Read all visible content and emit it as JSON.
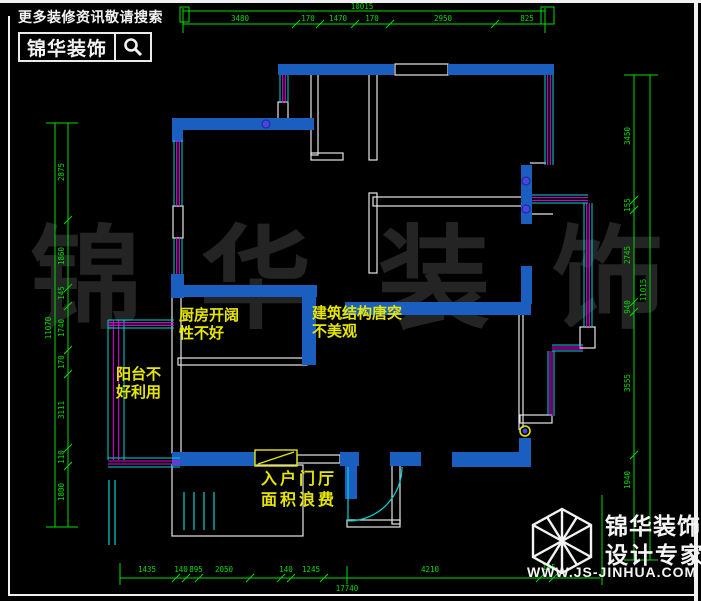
{
  "header": {
    "tagline": "更多装修资讯敬请搜索",
    "brand": "锦华装饰",
    "search_icon": "magnifier-icon"
  },
  "footer": {
    "brand_line1": "锦华装饰",
    "brand_line2": "设计专家",
    "website": "WWW.JS-JINHUA.COM",
    "logo_icon": "wireframe-cube-logo"
  },
  "watermark": {
    "chars": [
      "锦",
      "华",
      "装",
      "饰"
    ]
  },
  "annotations": [
    {
      "lines": [
        "厨房开阔",
        "性不好"
      ]
    },
    {
      "lines": [
        "建筑结构唐突",
        "不美观"
      ]
    },
    {
      "lines": [
        "阳台不",
        "好利用"
      ]
    },
    {
      "lines": [
        "入户门厅",
        "面积浪费"
      ]
    }
  ],
  "colors": {
    "wall": "#1a5fc0",
    "line": "#e6e6e6",
    "green": "#00dc00",
    "magenta": "#e800e8",
    "cyan": "#00d2d2",
    "yellow": "#e6e600",
    "hinge": "#4747e0",
    "bg": "#000000",
    "frame": "#f0f0f0"
  },
  "plan": {
    "walls": [
      [
        278,
        64,
        116,
        11
      ],
      [
        448,
        64,
        106,
        11
      ],
      [
        172,
        118,
        142,
        12
      ],
      [
        172,
        118,
        11,
        24
      ],
      [
        171,
        274,
        13,
        24
      ],
      [
        171,
        285,
        146,
        12
      ],
      [
        302,
        297,
        14,
        68
      ],
      [
        345,
        302,
        186,
        13
      ],
      [
        521,
        266,
        11,
        38
      ],
      [
        521,
        165,
        11,
        59
      ],
      [
        172,
        452,
        83,
        14
      ],
      [
        340,
        452,
        19,
        14
      ],
      [
        390,
        452,
        31,
        14
      ],
      [
        452,
        452,
        79,
        15
      ],
      [
        345,
        465,
        12,
        34
      ],
      [
        519,
        438,
        12,
        16
      ]
    ],
    "white_rects": [
      [
        395,
        64,
        53,
        11
      ],
      [
        311,
        74,
        7,
        81
      ],
      [
        311,
        153,
        32,
        7
      ],
      [
        369,
        74,
        8,
        86
      ],
      [
        369,
        193,
        8,
        80
      ],
      [
        373,
        197,
        154,
        9
      ],
      [
        178,
        358,
        129,
        7
      ],
      [
        172,
        297,
        9,
        156
      ],
      [
        278,
        102,
        10,
        17
      ],
      [
        173,
        206,
        10,
        32
      ],
      [
        172,
        465,
        131,
        71
      ],
      [
        392,
        465,
        8,
        59
      ],
      [
        347,
        520,
        53,
        7
      ],
      [
        297,
        455,
        43,
        8
      ],
      [
        580,
        327,
        15,
        21
      ],
      [
        520,
        415,
        32,
        8
      ]
    ],
    "white_lines": [
      [
        530,
        163,
        546,
        163
      ],
      [
        530,
        214,
        553,
        214
      ],
      [
        519,
        315,
        519,
        430
      ],
      [
        523,
        315,
        523,
        428
      ]
    ],
    "windows": [
      [
        "v",
        280,
        75,
        8,
        28
      ],
      [
        "v",
        174,
        140,
        8,
        66
      ],
      [
        "v",
        174,
        238,
        8,
        36
      ],
      [
        "v",
        545,
        75,
        8,
        90
      ],
      [
        "v",
        584,
        203,
        8,
        124
      ],
      [
        "v",
        548,
        351,
        6,
        65
      ],
      [
        "v",
        108,
        320,
        16,
        140
      ],
      [
        "h",
        532,
        195,
        8,
        56
      ],
      [
        "h",
        552,
        345,
        6,
        31
      ],
      [
        "h",
        108,
        458,
        9,
        72
      ],
      [
        "h",
        108,
        320,
        8,
        66
      ]
    ],
    "cyan_lines": [
      [
        184,
        492,
        184,
        530
      ],
      [
        194,
        492,
        194,
        530
      ],
      [
        204,
        492,
        204,
        530
      ],
      [
        214,
        492,
        214,
        530
      ],
      [
        348,
        467,
        348,
        521
      ],
      [
        109,
        480,
        109,
        545
      ],
      [
        115,
        480,
        115,
        545
      ]
    ],
    "arcs": [
      {
        "d": "M 348 521 A 54 54 0 0 0 402 467"
      }
    ],
    "yellow_rects": [
      [
        255,
        450,
        42,
        16
      ]
    ],
    "yellow_lines": [
      [
        258,
        464,
        294,
        452
      ]
    ],
    "ring_dots": [
      {
        "x": 525,
        "y": 431,
        "r": 5
      }
    ],
    "hinge_dots": [
      {
        "x": 266,
        "y": 124,
        "r": 4
      },
      {
        "x": 526,
        "y": 181,
        "r": 4
      },
      {
        "x": 526,
        "y": 209,
        "r": 4
      }
    ],
    "green": {
      "lines": [
        [
          183,
          11,
          545,
          11
        ],
        [
          183,
          24,
          545,
          24
        ],
        [
          183,
          8,
          183,
          33
        ],
        [
          545,
          8,
          545,
          33
        ],
        [
          55,
          123,
          55,
          527
        ],
        [
          68,
          123,
          68,
          527
        ],
        [
          46,
          123,
          78,
          123
        ],
        [
          46,
          527,
          78,
          527
        ],
        [
          634,
          75,
          634,
          560
        ],
        [
          650,
          75,
          650,
          560
        ],
        [
          624,
          75,
          658,
          75
        ],
        [
          624,
          560,
          658,
          560
        ],
        [
          120,
          578,
          600,
          578
        ],
        [
          120,
          563,
          120,
          585
        ],
        [
          602,
          495,
          602,
          585
        ],
        [
          347,
          566,
          347,
          584
        ]
      ],
      "rects": [
        [
          180,
          7,
          9,
          15
        ],
        [
          541,
          7,
          13,
          17
        ]
      ],
      "ticks": [
        [
          296,
          24
        ],
        [
          320,
          24
        ],
        [
          355,
          24
        ],
        [
          390,
          24
        ],
        [
          495,
          24
        ],
        [
          68,
          220
        ],
        [
          68,
          288
        ],
        [
          68,
          306
        ],
        [
          68,
          350
        ],
        [
          68,
          374
        ],
        [
          68,
          448
        ],
        [
          68,
          466
        ],
        [
          634,
          200
        ],
        [
          634,
          210
        ],
        [
          634,
          302
        ],
        [
          634,
          312
        ],
        [
          634,
          455
        ],
        [
          176,
          578
        ],
        [
          186,
          578
        ],
        [
          199,
          578
        ],
        [
          250,
          578
        ],
        [
          281,
          578
        ],
        [
          291,
          578
        ],
        [
          324,
          578
        ],
        [
          540,
          578
        ],
        [
          553,
          578
        ]
      ],
      "texts": [
        {
          "t": "10015",
          "x": 362,
          "y": 9
        },
        {
          "t": "3480",
          "x": 240,
          "y": 21
        },
        {
          "t": "170",
          "x": 308,
          "y": 21
        },
        {
          "t": "1470",
          "x": 338,
          "y": 21
        },
        {
          "t": "170",
          "x": 372,
          "y": 21
        },
        {
          "t": "2950",
          "x": 443,
          "y": 21
        },
        {
          "t": "825",
          "x": 527,
          "y": 21
        },
        {
          "t": "11070",
          "x": 51,
          "y": 328,
          "r": 1
        },
        {
          "t": "2875",
          "x": 64,
          "y": 172,
          "r": 1
        },
        {
          "t": "1860",
          "x": 64,
          "y": 256,
          "r": 1
        },
        {
          "t": "145",
          "x": 64,
          "y": 293,
          "r": 1
        },
        {
          "t": "1740",
          "x": 64,
          "y": 328,
          "r": 1
        },
        {
          "t": "170",
          "x": 64,
          "y": 362,
          "r": 1
        },
        {
          "t": "3111",
          "x": 64,
          "y": 410,
          "r": 1
        },
        {
          "t": "110",
          "x": 64,
          "y": 457,
          "r": 1
        },
        {
          "t": "1800",
          "x": 64,
          "y": 492,
          "r": 1
        },
        {
          "t": "3450",
          "x": 630,
          "y": 136,
          "r": 1
        },
        {
          "t": "155",
          "x": 630,
          "y": 205,
          "r": 1
        },
        {
          "t": "2745",
          "x": 630,
          "y": 255,
          "r": 1
        },
        {
          "t": "940",
          "x": 630,
          "y": 307,
          "r": 1
        },
        {
          "t": "3555",
          "x": 630,
          "y": 383,
          "r": 1
        },
        {
          "t": "1940",
          "x": 630,
          "y": 480,
          "r": 1
        },
        {
          "t": "11015",
          "x": 646,
          "y": 290,
          "r": 1
        },
        {
          "t": "1435",
          "x": 147,
          "y": 572
        },
        {
          "t": "140",
          "x": 181,
          "y": 572
        },
        {
          "t": "895",
          "x": 196,
          "y": 572
        },
        {
          "t": "2050",
          "x": 224,
          "y": 572
        },
        {
          "t": "140",
          "x": 286,
          "y": 572
        },
        {
          "t": "1245",
          "x": 311,
          "y": 572
        },
        {
          "t": "4210",
          "x": 430,
          "y": 572
        },
        {
          "t": "145",
          "x": 549,
          "y": 570
        },
        {
          "t": "17740",
          "x": 347,
          "y": 591
        }
      ]
    }
  }
}
